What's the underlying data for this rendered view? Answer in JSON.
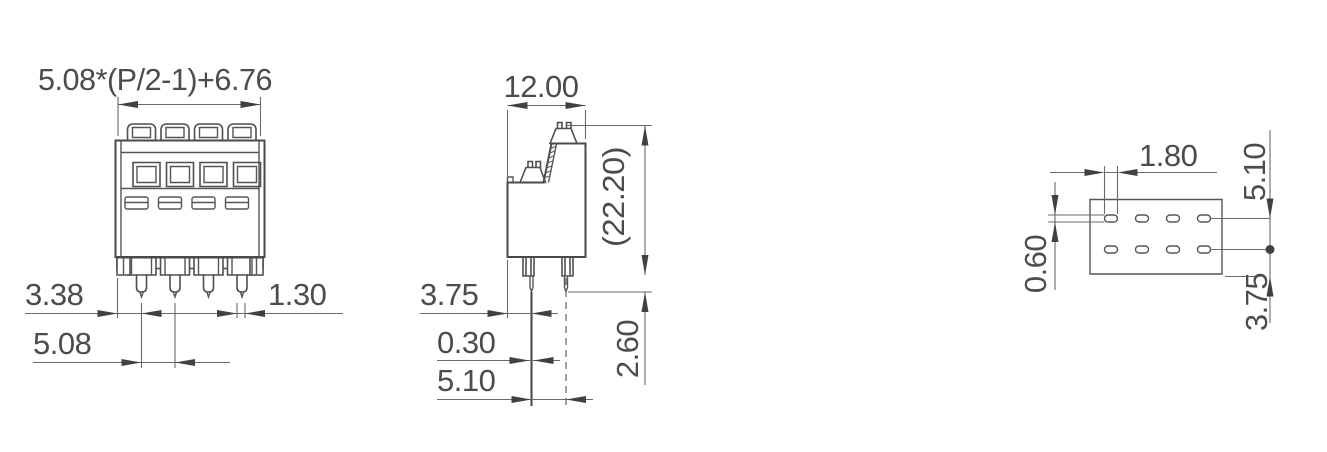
{
  "front_view": {
    "width_formula": "5.08*(P/2-1)+6.76",
    "edge_to_first_pin": "3.38",
    "pin_width": "1.30",
    "pin_pitch": "5.08"
  },
  "side_view": {
    "body_depth": "12.00",
    "overall_height_ref": "(22.20)",
    "edge_to_pin_row": "3.75",
    "pin_thickness": "0.30",
    "pin_row_spacing": "5.10",
    "pin_protrusion": "2.60"
  },
  "footprint_view": {
    "slot_width": "1.80",
    "row_spacing": "5.10",
    "slot_height": "0.60",
    "row_to_edge": "3.75"
  },
  "colors": {
    "outline": "#4a4a4a",
    "dimension_line": "#6a6a6a",
    "text": "#4c4c4c",
    "background": "#ffffff"
  }
}
